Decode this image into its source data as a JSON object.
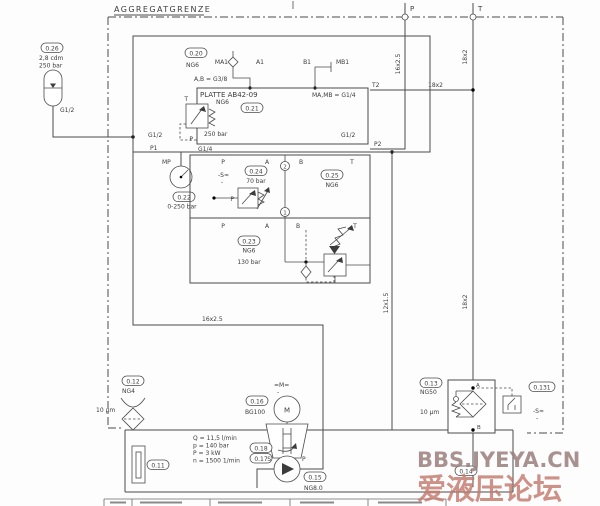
{
  "boundary": {
    "title": "AGGREGATGRENZE"
  },
  "external_ports": {
    "p": "P",
    "t": "T"
  },
  "pipes": {
    "p_line": "16x2.5",
    "t_line_upper": "18x2",
    "t2_line": "18x2",
    "t_line_lower": "18x2",
    "leak_line": "12x1.5",
    "pressure_line": "16x2.5"
  },
  "accumulator": {
    "ref": "0.26",
    "volume": "2,8 cdm",
    "pressure": "250 bar",
    "port": "G1/2"
  },
  "manifold": {
    "ref": "0.20",
    "size": "NG6",
    "ports_ab": "A,B = G3/8",
    "ports_mamb": "MA,MB = G1/4",
    "ma1": "MA1",
    "a1": "A1",
    "b1": "B1",
    "mb1": "MB1",
    "t2": "T2",
    "p2": "P2",
    "p1": "P1",
    "g12_left": "G1/2",
    "g12_right": "G1/2",
    "g14": "G1/4",
    "mp": "MP"
  },
  "platte": {
    "title": "PLATTE AB42-09",
    "size": "NG6",
    "ref": "0.21",
    "pressure": "250 bar",
    "port_t": "T",
    "port_p": "P"
  },
  "gauge": {
    "ref": "0.22",
    "range": "0-250 bar"
  },
  "valve_block": {
    "top_ports": [
      "P",
      "A",
      "B",
      "T"
    ],
    "mid_ports": [
      "P",
      "A",
      "B",
      "T"
    ],
    "pos2": "2",
    "pos1": "1",
    "reducing_valve": {
      "ref": "0.24",
      "pressure": "70 bar",
      "tag": "-S≈",
      "tag2": "-",
      "port_p": "P"
    },
    "directional_valve": {
      "ref": "0.25",
      "size": "NG6"
    },
    "sequence_valve": {
      "ref": "0.23",
      "size": "NG6",
      "pressure": "130 bar"
    }
  },
  "power_unit": {
    "motor": {
      "ref": "0.16",
      "size": "BG100",
      "symbol": "M",
      "tag": "=M=",
      "tag2": "-"
    },
    "coupling": {
      "ref_top": "0.18",
      "ref_bottom": "0.17"
    },
    "pump": {
      "ref": "0.15",
      "size": "NG8.0",
      "suction": "S",
      "pressure": "P"
    },
    "specs": {
      "q": "Q = 11,5 l/min",
      "p": "p = 140 bar",
      "power": "P = 3 kW",
      "n": "n = 1500 1/min"
    }
  },
  "breather": {
    "ref": "0.12",
    "size": "NG4",
    "micron": "10 µm"
  },
  "level_gauge": {
    "ref": "0.11"
  },
  "return_filter": {
    "ref": "0.13",
    "size": "NG50",
    "micron": "10 µm",
    "port_a": "A",
    "port_b": "B",
    "indicator": {
      "ref": "0.131",
      "tag": "-S≈",
      "tag2": "-"
    }
  },
  "return_line": {
    "ref": "0.14"
  },
  "watermark": {
    "line1": "BBS.JYEYA.CN",
    "line2": "爱液压论坛"
  }
}
